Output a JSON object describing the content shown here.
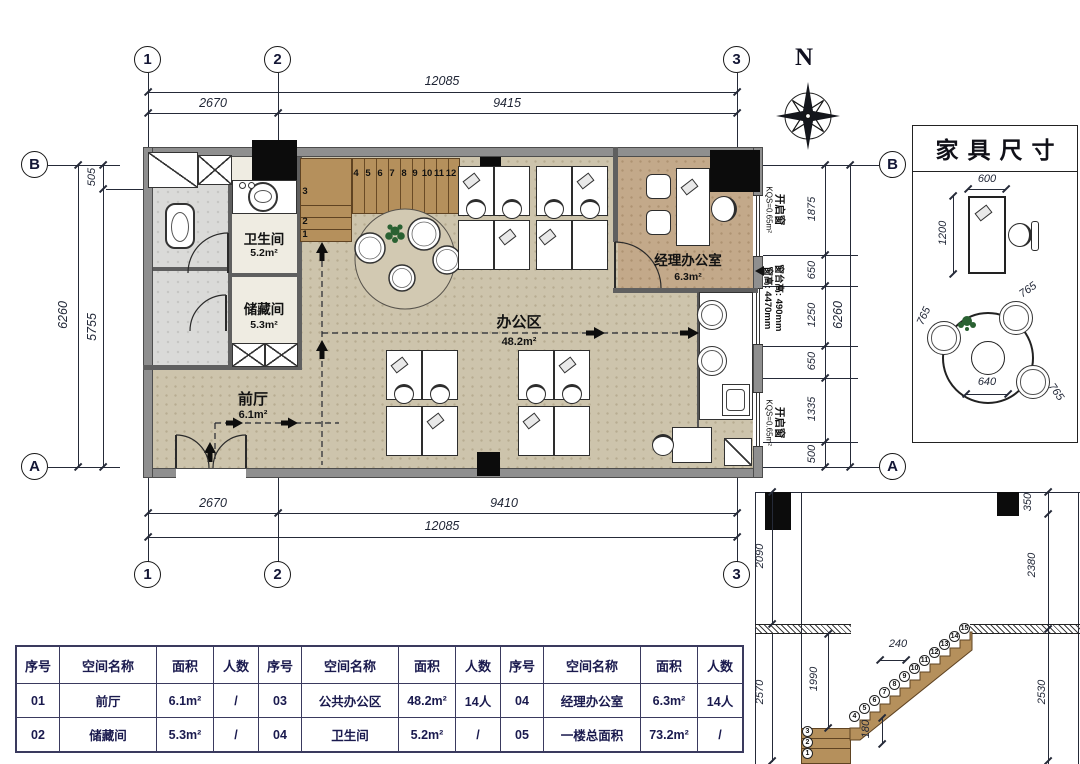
{
  "grid": {
    "c1": "1",
    "c2": "2",
    "c3": "3",
    "rB": "B",
    "rA": "A"
  },
  "dims": {
    "top": {
      "total": "12085",
      "seg1": "2670",
      "seg2": "9415"
    },
    "bottom": {
      "total": "12085",
      "seg1": "2670",
      "seg2": "9410"
    },
    "left": {
      "total": "6260",
      "seg1": "505",
      "seg2": "5755"
    },
    "right": {
      "total": "6260",
      "s0": "1875",
      "s1": "650",
      "s2": "1250",
      "s3": "650",
      "s4": "1335",
      "s5": "500"
    }
  },
  "compass": {
    "label": "N"
  },
  "plan": {
    "rooms": {
      "bathroom": {
        "name": "卫生间",
        "area": "5.2m²"
      },
      "storage": {
        "name": "储藏间",
        "area": "5.3m²"
      },
      "foyer": {
        "name": "前厅",
        "area": "6.1m²"
      },
      "office": {
        "name": "办公区",
        "area": "48.2m²"
      },
      "manager": {
        "name": "经理办公室",
        "area": "6.3m²"
      }
    },
    "windows": {
      "opening_top": {
        "line1": "开启窗",
        "line2": "KQS=0.65m²"
      },
      "sill": {
        "line1": "窗台高: 490mm",
        "line2": "窗高: 4470mm"
      },
      "opening_bottom": {
        "line1": "开启窗",
        "line2": "KQS=0.65m²"
      }
    },
    "stair_numbers": [
      "1",
      "2",
      "3",
      "4",
      "5",
      "6",
      "7",
      "8",
      "9",
      "10",
      "11",
      "12"
    ]
  },
  "furniture": {
    "title": "家具尺寸",
    "desk_w": "600",
    "desk_d": "1200",
    "chair1": "765",
    "chair2": "765",
    "chair3": "765",
    "table_d": "640"
  },
  "section": {
    "d_2090": "2090",
    "d_2570": "2570",
    "d_1990": "1990",
    "d_240": "240",
    "d_180": "180",
    "d_350": "350",
    "d_2380": "2380",
    "d_2530": "2530",
    "steps": [
      "1",
      "2",
      "3",
      "4",
      "5",
      "6",
      "7",
      "8",
      "9",
      "10",
      "11",
      "12",
      "13",
      "14",
      "15"
    ]
  },
  "table": {
    "headers": [
      "序号",
      "空间名称",
      "面积",
      "人数"
    ],
    "rows": [
      [
        "01",
        "前厅",
        "6.1m²",
        "/",
        "03",
        "公共办公区",
        "48.2m²",
        "14人",
        "04",
        "经理办公室",
        "6.3m²",
        "14人"
      ],
      [
        "02",
        "储藏间",
        "5.3m²",
        "/",
        "04",
        "卫生间",
        "5.2m²",
        "/",
        "05",
        "一楼总面积",
        "73.2m²",
        "/"
      ]
    ]
  }
}
